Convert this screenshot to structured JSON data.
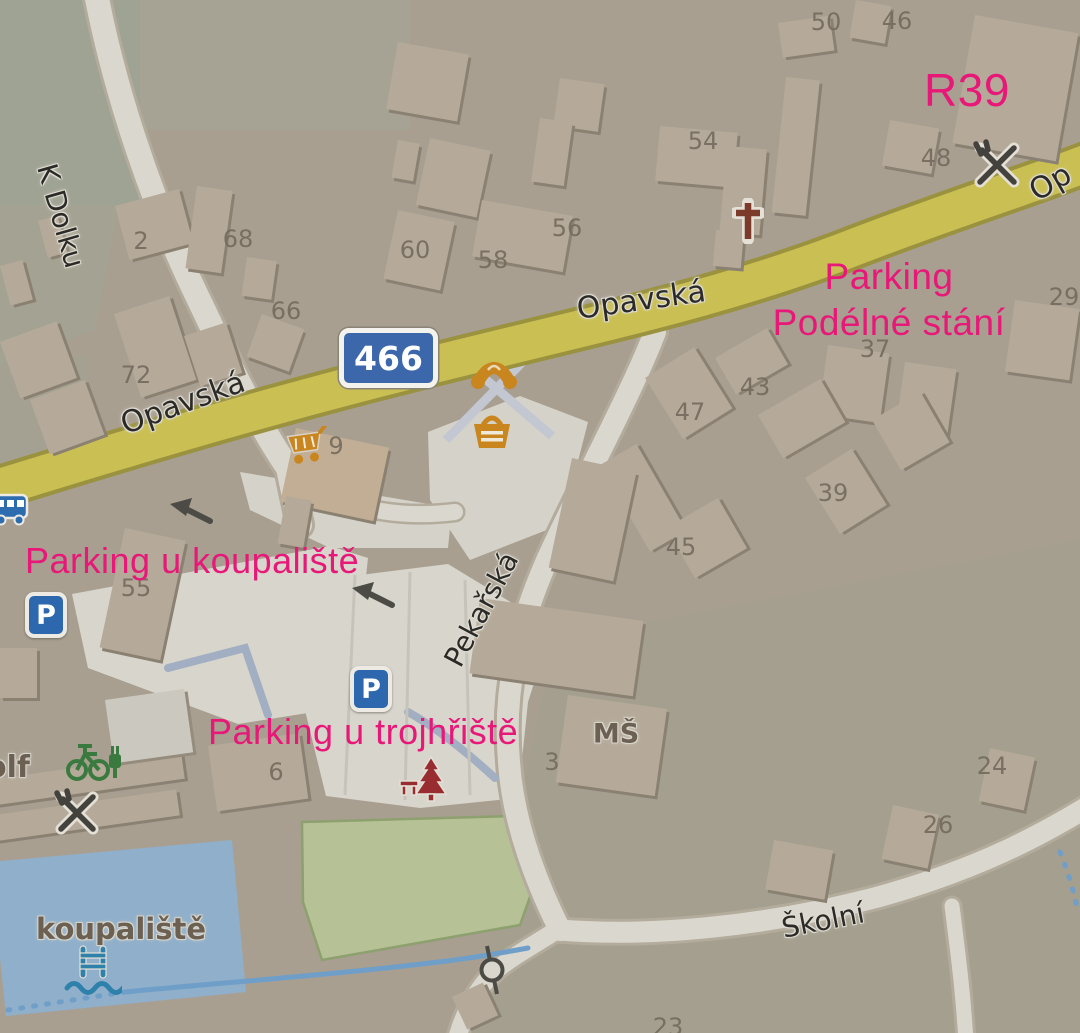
{
  "annotations": {
    "color": "#e81878",
    "r39": "R39",
    "parking_podelne": {
      "line1": "Parking",
      "line2": "Podélné stání"
    },
    "parking_koupaliste": "Parking u koupaliště",
    "parking_trojhriste": "Parking u trojhřiště"
  },
  "streets": {
    "k_dolku": "K Dolku",
    "opavska_west": "Opavská",
    "opavska_center": "Opavská",
    "opavska_northeast": "Op",
    "pekarska": "Pekařská",
    "skolni": "Školní"
  },
  "route_shield": {
    "number": "466"
  },
  "pois": {
    "koupaliste": "koupaliště",
    "kindergarten": "MŠ",
    "golf_partial": "olf",
    "parking_sign": "P"
  },
  "house_numbers": [
    "50",
    "46",
    "54",
    "48",
    "56",
    "58",
    "60",
    "2",
    "68",
    "66",
    "72",
    "29",
    "37",
    "43",
    "47",
    "39",
    "45",
    "55",
    "9",
    "6",
    "3",
    "24",
    "26",
    "23"
  ],
  "icons": {
    "bus-icon": "blue bus stop",
    "supermarket-icon": "orange shopping cart",
    "bakery-icon": "orange croissant",
    "convenience-icon": "orange shopping basket",
    "church-icon": "dark red cross",
    "restaurant-icon-north": "crossed fork and knife",
    "restaurant-icon-south": "crossed fork and knife",
    "bike-charging-icon": "green bicycle with charging plug",
    "playground-icon": "dark red tree with bench",
    "pool-ladder-icon": "blue pool ladder with waves",
    "parking-sign-icon": "blue square with white P",
    "oneway-arrow-icon": "dark gray arrow",
    "gate-icon": "circle node with bar on path"
  },
  "colors": {
    "land": "#a89f91",
    "main_road": "#cabf52",
    "minor_road": "#dad7ce",
    "building": "#b5aa99",
    "water": "#8fafca",
    "field": "#b6c296",
    "footpath": "#a2afc2",
    "annotation": "#e81878"
  }
}
